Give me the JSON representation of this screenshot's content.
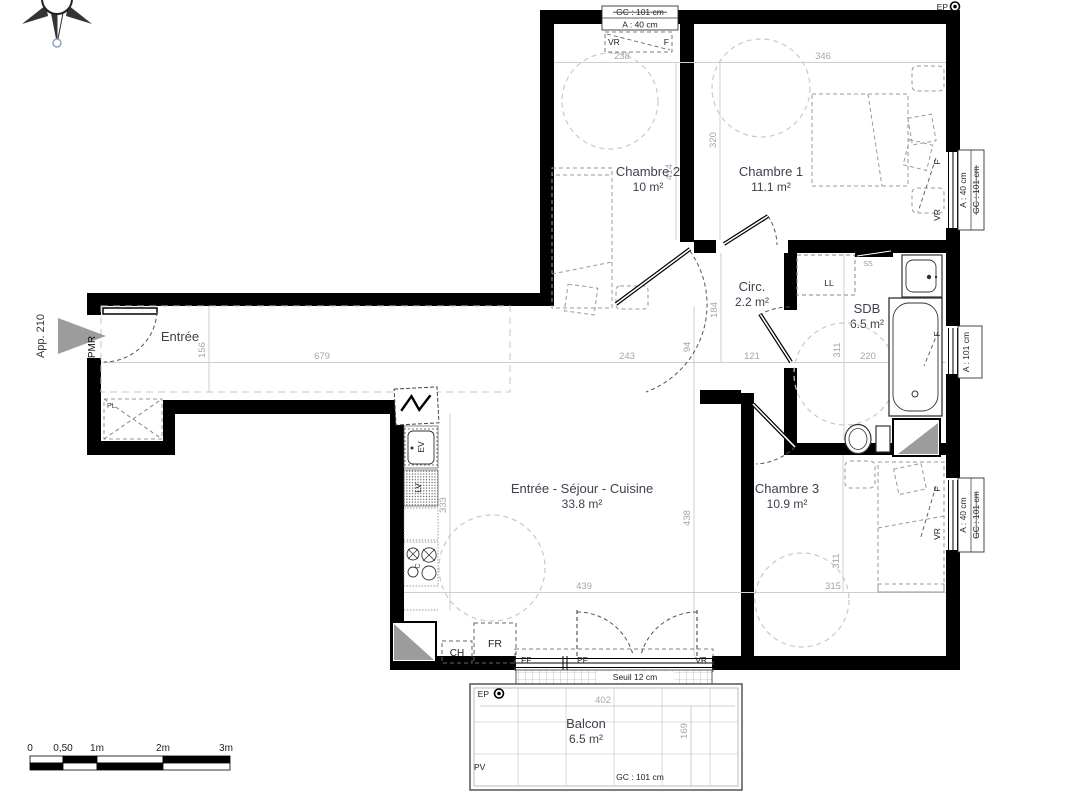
{
  "plan": {
    "apartment": "App. 210",
    "entrance_accessibility": "PMR"
  },
  "rooms": {
    "entree": {
      "name": "Entrée"
    },
    "chambre2": {
      "name": "Chambre 2",
      "area": "10 m²"
    },
    "chambre1": {
      "name": "Chambre 1",
      "area": "11.1 m²"
    },
    "circ": {
      "name": "Circ.",
      "area": "2.2 m²"
    },
    "sdb": {
      "name": "SDB",
      "area": "6.5 m²"
    },
    "sejour": {
      "name": "Entrée - Séjour - Cuisine",
      "area": "33.8 m²"
    },
    "chambre3": {
      "name": "Chambre 3",
      "area": "10.9 m²"
    },
    "balcon": {
      "name": "Balcon",
      "area": "6.5 m²"
    }
  },
  "fixtures": {
    "pl": "PL",
    "ll": "LL",
    "ss": "SS",
    "ev": "EV",
    "lv": "LV",
    "c": "C",
    "ch": "CH",
    "fr": "FR",
    "pv": "PV",
    "ep": "EP"
  },
  "windows": {
    "top": {
      "gc": "GC : 101 cm",
      "a": "A : 40 cm",
      "vr": "VR",
      "f": "F"
    },
    "ch1": {
      "a": "A : 40 cm",
      "gc": "GC : 101 cm",
      "f": "F",
      "vr": "VR"
    },
    "sdb": {
      "a": "A : 101 cm",
      "f": "F"
    },
    "ch3": {
      "a": "A : 40 cm",
      "gc": "GC : 101 cm",
      "f": "F",
      "vr": "VR"
    },
    "bay": {
      "ff": "FF",
      "pf": "PF",
      "vr": "VR"
    },
    "seuil": "Seuil 12 cm",
    "balcony_gc": "GC : 101 cm"
  },
  "dimensions": {
    "d238": "238",
    "d346": "346",
    "d320": "320",
    "d414": "414",
    "d184": "184",
    "d94": "94",
    "d156": "156",
    "d679": "679",
    "d243": "243",
    "d121": "121",
    "d220": "220",
    "d311_sdb": "311",
    "d333": "333",
    "d438": "438",
    "d439": "439",
    "d311_ch3": "311",
    "d315": "315",
    "d402": "402",
    "d169": "169"
  },
  "scale_bar": {
    "t0": "0",
    "t05": "0,50",
    "t1": "1m",
    "t2": "2m",
    "t3": "3m"
  }
}
